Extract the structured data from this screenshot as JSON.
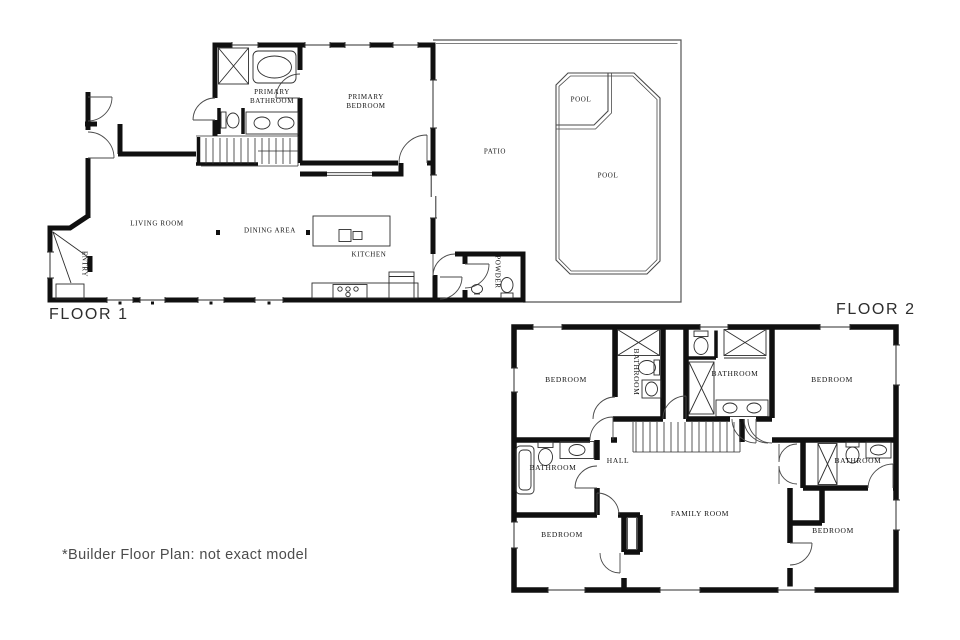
{
  "document": {
    "type": "builder floor plan, two floors",
    "footnote": "*Builder Floor Plan: not exact model"
  },
  "colors": {
    "background": "#ffffff",
    "wall": "#101010",
    "thin_line": "#2e2e2e",
    "door_arc": "#4a4a4a",
    "title_text": "#2e2e2e",
    "label_text": "#141414",
    "footnote_text": "#4c4c4c"
  },
  "floor1": {
    "title": "FLOOR 1",
    "labels": {
      "primary_bathroom": "PRIMARY BATHROOM",
      "primary_bedroom": "PRIMARY BEDROOM",
      "patio": "PATIO",
      "pool_upper": "POOL",
      "pool_main": "POOL",
      "living_room": "LIVING ROOM",
      "dining_area": "DINING AREA",
      "kitchen": "KITCHEN",
      "entry": "ENTRY",
      "powder": "POWDER"
    }
  },
  "floor2": {
    "title": "FLOOR 2",
    "labels": {
      "bedroom_top_left": "BEDROOM",
      "bathroom_rotated": "BATHROOM",
      "bathroom_top_middle": "BATHROOM",
      "bedroom_top_right": "BEDROOM",
      "hall": "HALL",
      "bathroom_left": "BATHROOM",
      "bathroom_right": "BATHROOM",
      "family_room": "FAMILY ROOM",
      "bedroom_bottom_left": "BEDROOM",
      "bedroom_bottom_right": "BEDROOM"
    }
  }
}
